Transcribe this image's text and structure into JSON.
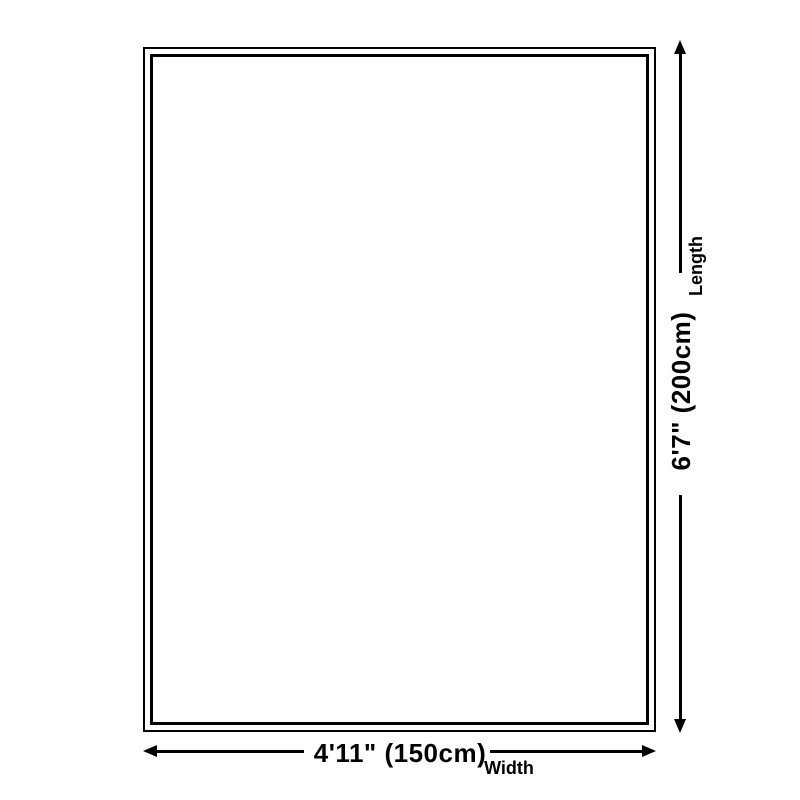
{
  "diagram": {
    "background_color": "#ffffff",
    "line_color": "#000000",
    "length": {
      "value": "6'7\" (200cm)",
      "label": "Length",
      "feet_inches": "6'7\"",
      "centimeters": 200
    },
    "width": {
      "value": "4'11\" (150cm)",
      "label": "Width",
      "feet_inches": "4'11\"",
      "centimeters": 150
    },
    "icons": {
      "arrow_up": "css-triangle-up",
      "arrow_down": "css-triangle-down",
      "arrow_left": "css-triangle-left",
      "arrow_right": "css-triangle-right"
    }
  }
}
